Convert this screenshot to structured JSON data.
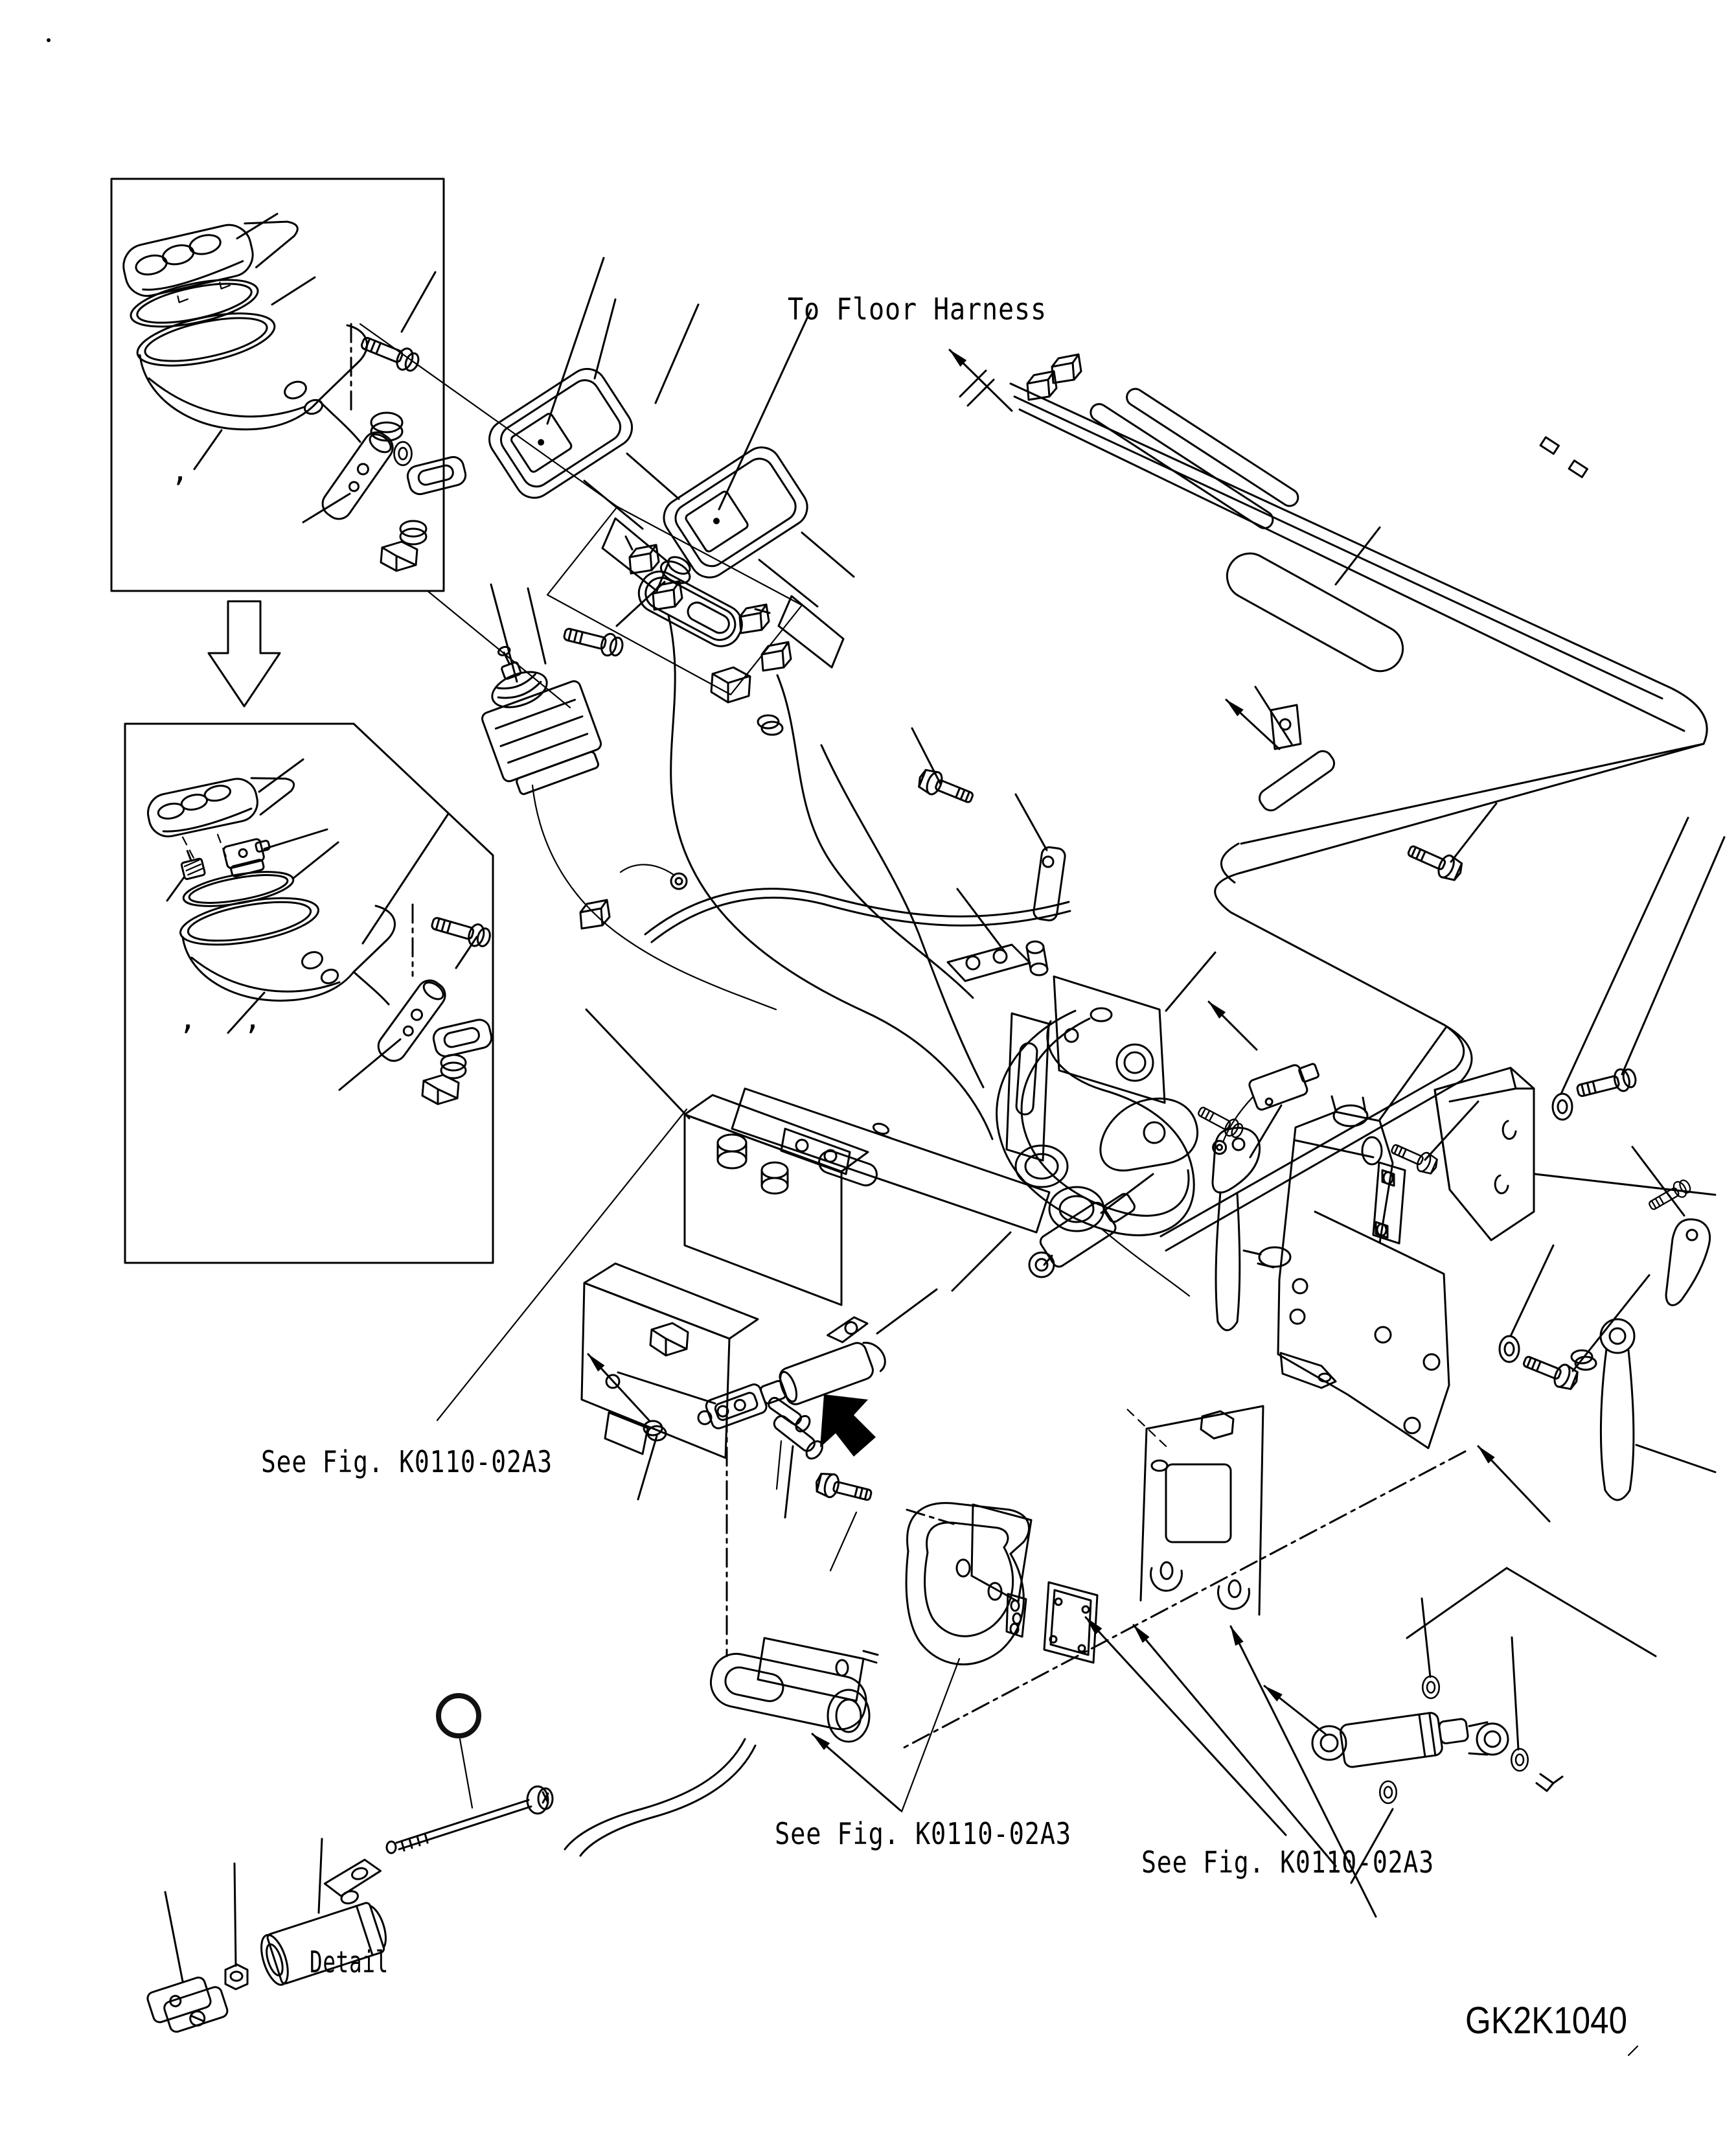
{
  "page": {
    "background": "#ffffff",
    "line_color": "#000000",
    "drawing_number": "GK2K1040"
  },
  "labels": {
    "to_floor_harness": "To Floor Harness",
    "see_fig_center_left": "See Fig. K0110-02A3",
    "see_fig_bottom_center": "See Fig. K0110-02A3",
    "see_fig_bottom_right": "See Fig. K0110-02A3",
    "detail": "Detail"
  },
  "commas": {
    "box1": ",",
    "box2_a": ",",
    "box2_b": ","
  },
  "callouts": {
    "item_10": {
      "number": "10",
      "fill": "#2b8a2b",
      "ring": "#111111",
      "text_color": "#ffffff"
    }
  },
  "icons": [
    "down-hollow-arrow-icon",
    "direction-arrow-icon",
    "bent-solid-arrow-icon"
  ]
}
